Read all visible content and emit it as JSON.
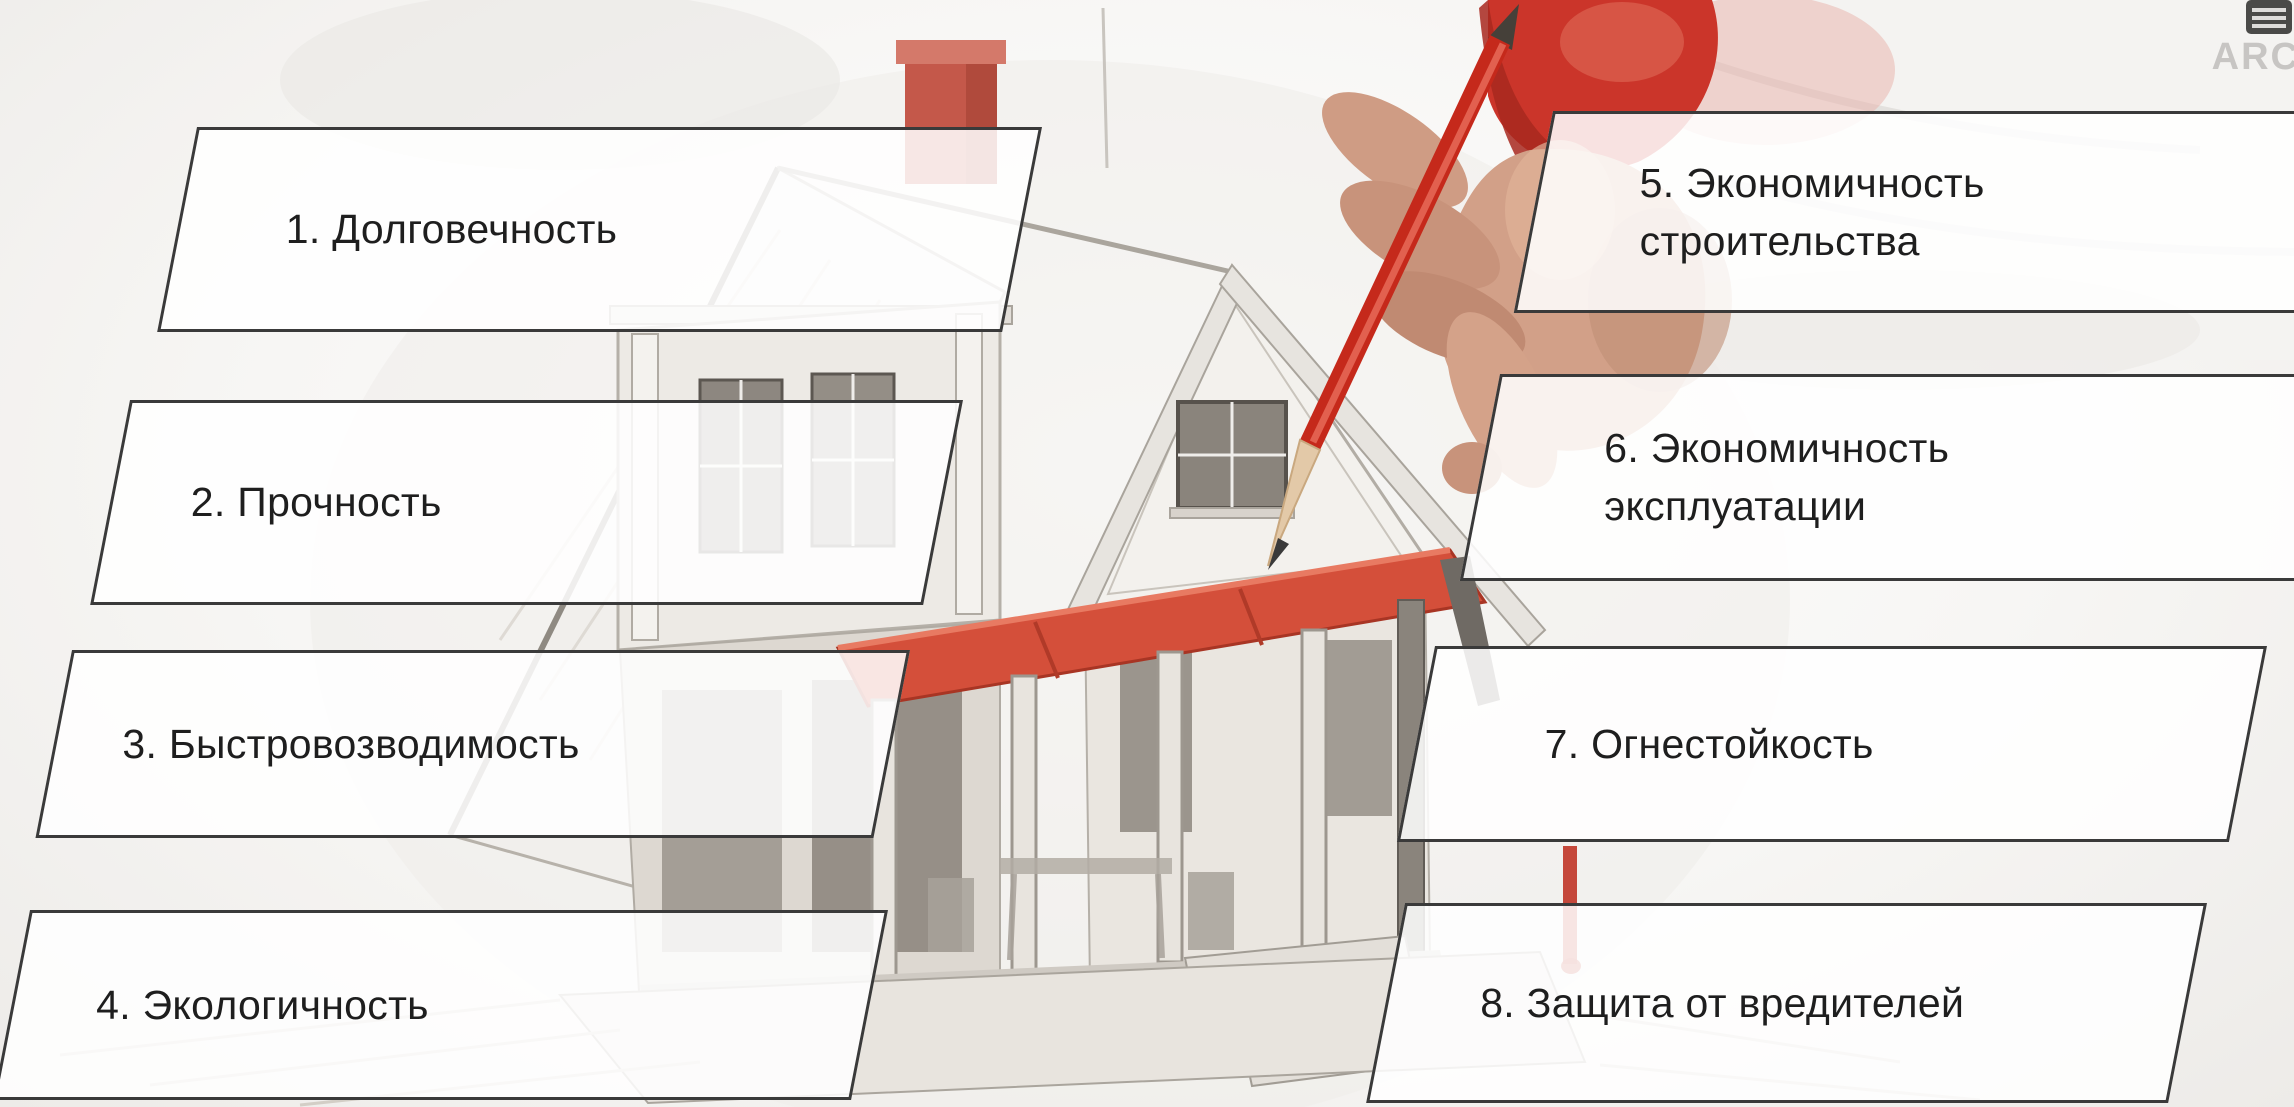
{
  "watermark": {
    "text": "ARC",
    "icon": "blinds-logo-icon"
  },
  "labels": [
    {
      "line1": "1. Долговечность"
    },
    {
      "line1": "2. Прочность"
    },
    {
      "line1": "3. Быстровозводимость"
    },
    {
      "line1": "4. Экологичность"
    },
    {
      "line1": "5. Экономичность",
      "line2": "строительства"
    },
    {
      "line1": "6. Экономичность",
      "line2": "эксплуатации"
    },
    {
      "line1": "7. Огнестойкость"
    },
    {
      "line1": "8. Защита от вредителей"
    }
  ],
  "colors": {
    "accent_red": "#c5392b",
    "awning_red": "#d44f3a",
    "label_border": "#3a3a3a",
    "label_fill": "#ffffff",
    "label_text": "#1e1e1e",
    "watermark_gray": "#c7c5c3",
    "sketch_gray": "#b5b0a8"
  },
  "illustration": {
    "description": "Pencil-sketch of a two-storey house with red chimney, red porch awning, columns and steps; a hand with a red pencil draws over it",
    "elements": [
      "house-sketch",
      "red-chimney",
      "roof",
      "attic-window",
      "red-awning",
      "porch-columns",
      "steps",
      "foundation",
      "hand",
      "red-pencil",
      "red-sleeve",
      "red-drip"
    ]
  }
}
